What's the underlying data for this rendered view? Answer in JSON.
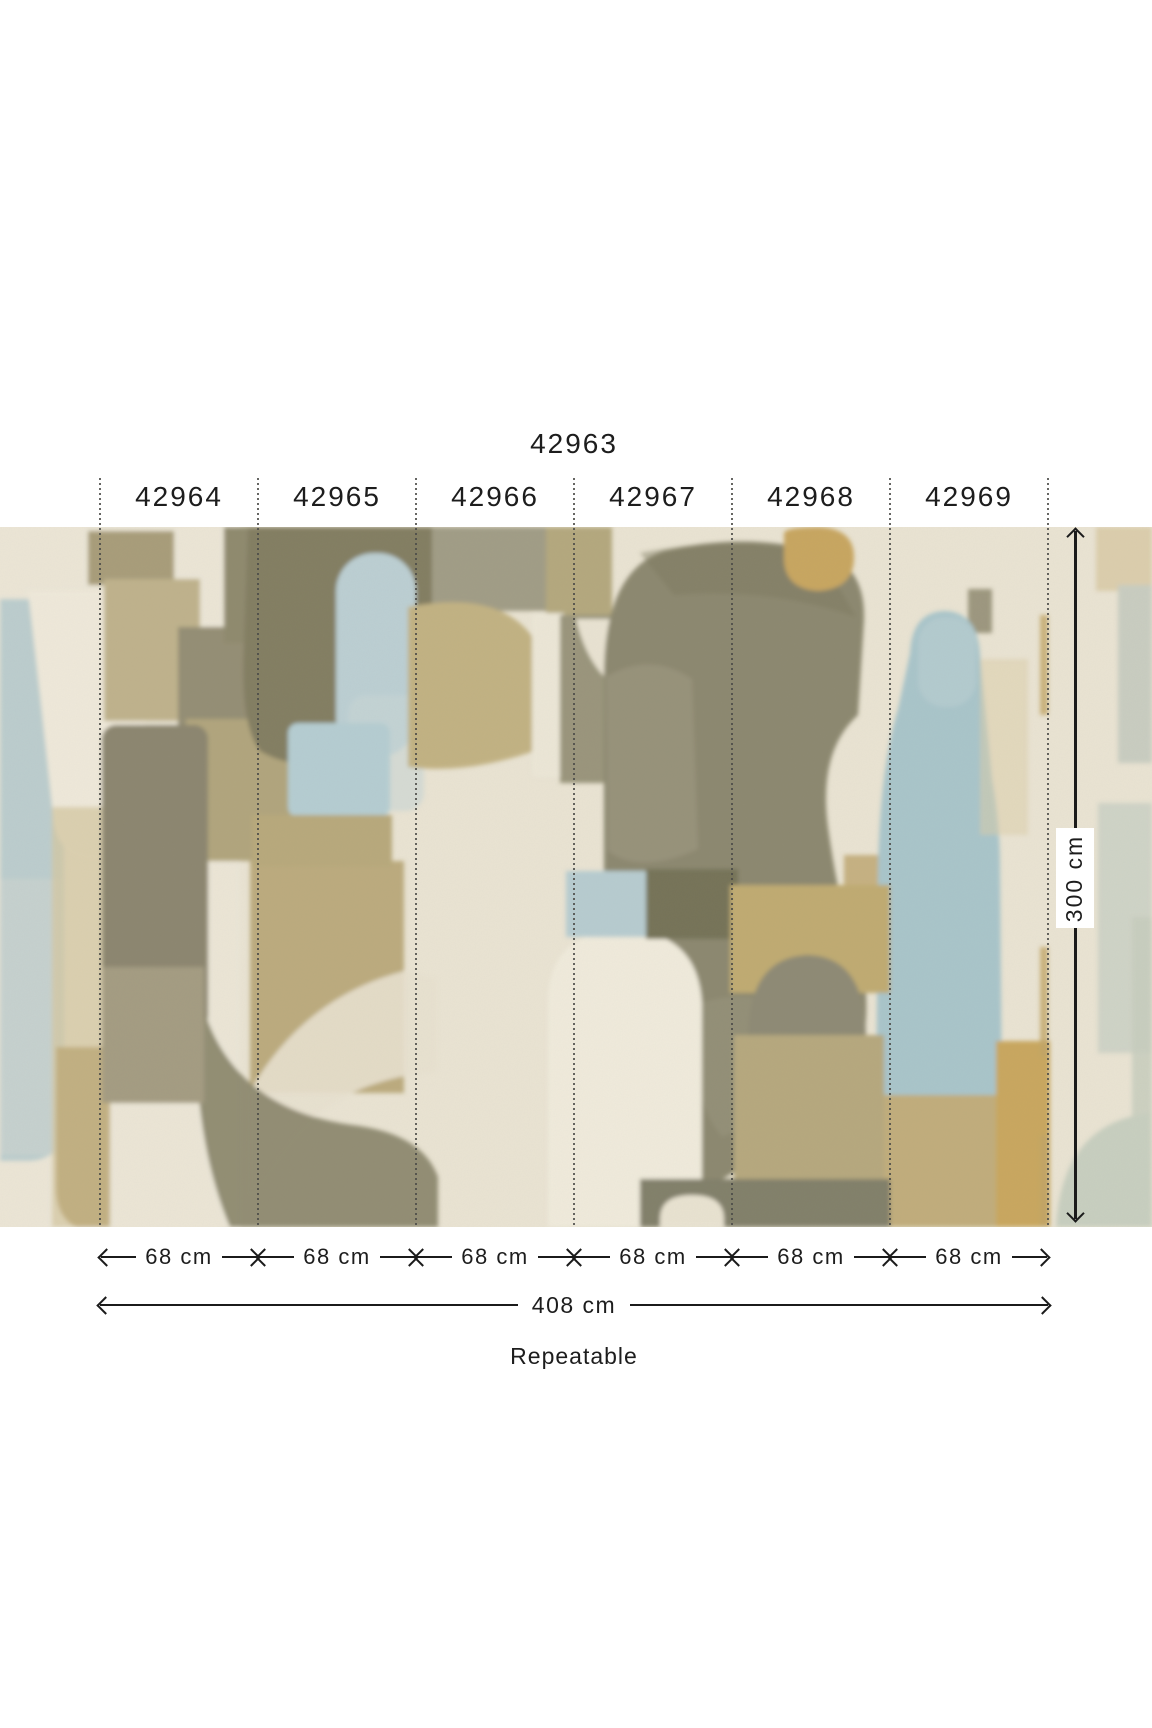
{
  "product": {
    "mural_code": "42963",
    "panels": [
      {
        "code": "42964",
        "width_label": "68 cm"
      },
      {
        "code": "42965",
        "width_label": "68 cm"
      },
      {
        "code": "42966",
        "width_label": "68 cm"
      },
      {
        "code": "42967",
        "width_label": "68 cm"
      },
      {
        "code": "42968",
        "width_label": "68 cm"
      },
      {
        "code": "42969",
        "width_label": "68 cm"
      },
      {
        "code": "42970",
        "width_label": "68 cm"
      }
    ],
    "total_width_label": "408 cm",
    "height_label": "300 cm",
    "repeat_note": "Repeatable"
  },
  "palette": {
    "ink": "#1b1b1b",
    "page_background": "#ffffff",
    "separator_dots": "#4b4b48",
    "artwork_cream": "#eae4d3",
    "artwork_olive": "#8c8870",
    "artwork_sage": "#a3a088",
    "artwork_tan": "#bcab7e",
    "artwork_ochre": "#c9a75f",
    "artwork_blue": "#aec7cb",
    "artwork_pale_blue": "#ced6d0",
    "artwork_white": "#f0ebdc"
  }
}
